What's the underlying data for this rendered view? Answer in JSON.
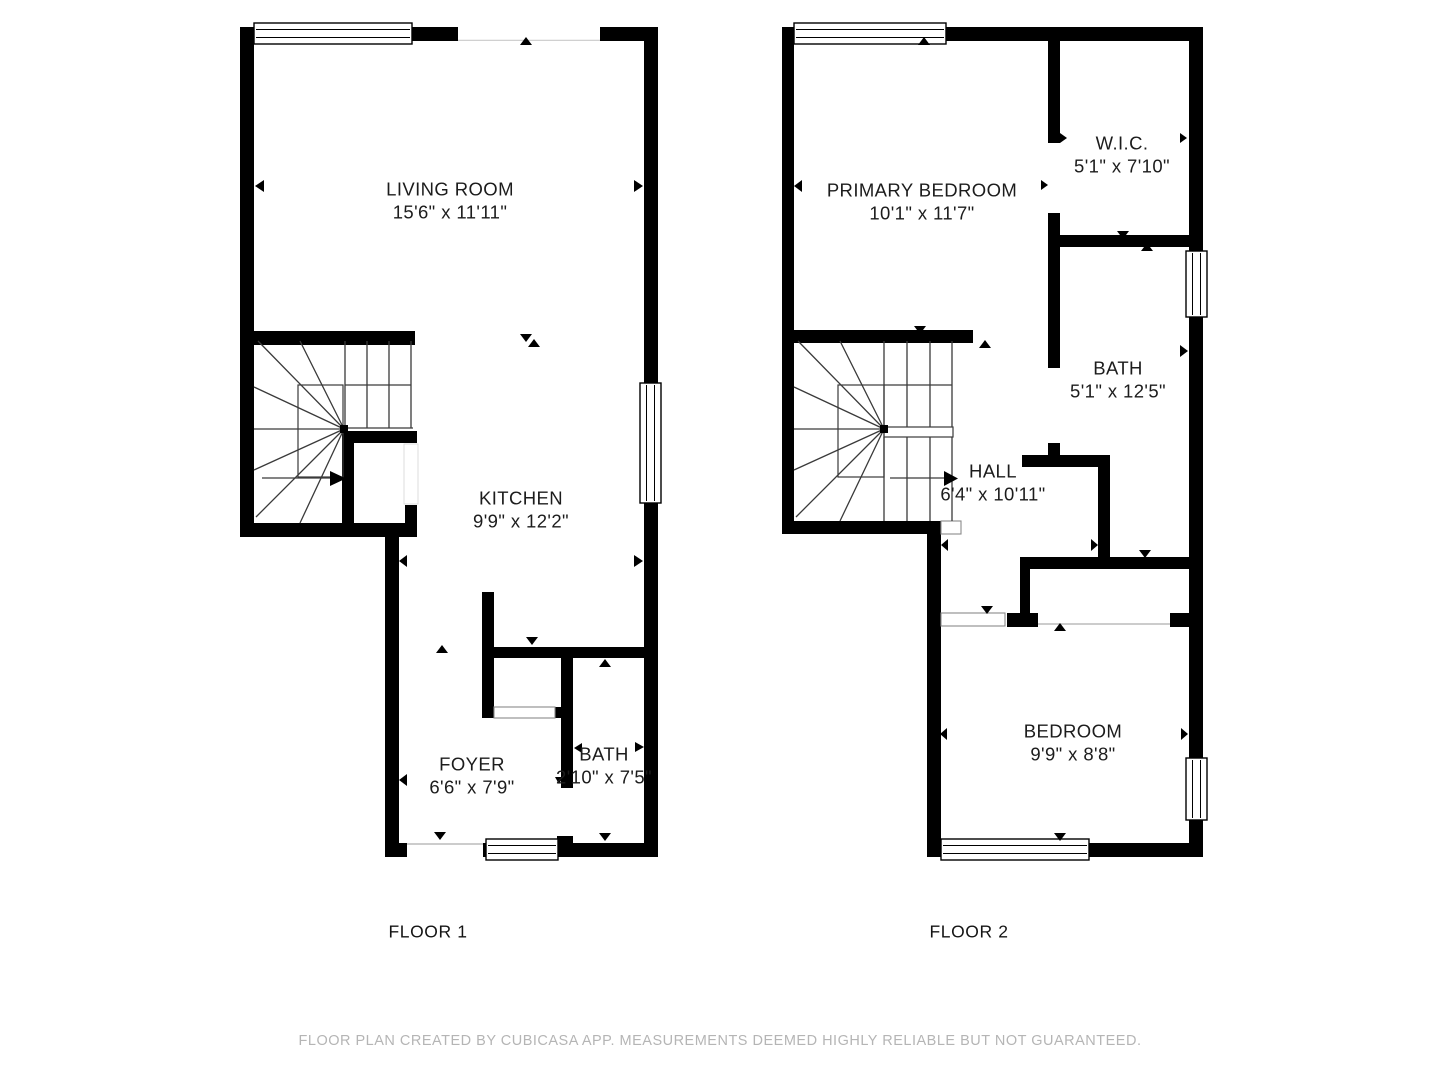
{
  "page": {
    "background_color": "#ffffff",
    "wall_color": "#000000",
    "footer_color": "#b5b5b5",
    "footer": "FLOOR PLAN CREATED BY CUBICASA APP. MEASUREMENTS DEEMED HIGHLY RELIABLE BUT NOT GUARANTEED."
  },
  "floors": [
    {
      "label": "FLOOR 1",
      "rooms": [
        {
          "name": "LIVING ROOM",
          "dims": "15'6\" x 11'11\""
        },
        {
          "name": "KITCHEN",
          "dims": "9'9\" x 12'2\""
        },
        {
          "name": "FOYER",
          "dims": "6'6\" x 7'9\""
        },
        {
          "name": "BATH",
          "dims": "2'10\" x 7'5\""
        }
      ]
    },
    {
      "label": "FLOOR 2",
      "rooms": [
        {
          "name": "PRIMARY BEDROOM",
          "dims": "10'1\" x 11'7\""
        },
        {
          "name": "W.I.C.",
          "dims": "5'1\" x 7'10\""
        },
        {
          "name": "BATH",
          "dims": "5'1\" x 12'5\""
        },
        {
          "name": "HALL",
          "dims": "6'4\" x 10'11\""
        },
        {
          "name": "BEDROOM",
          "dims": "9'9\" x 8'8\""
        }
      ]
    }
  ]
}
